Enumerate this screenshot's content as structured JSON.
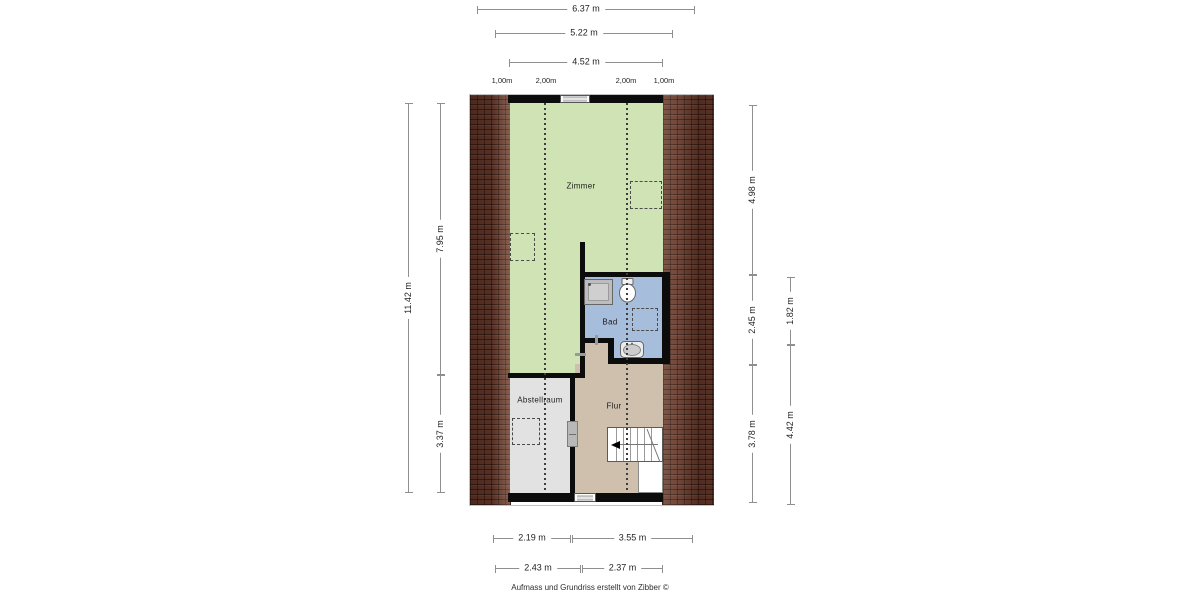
{
  "rooms": {
    "zimmer": "Zimmer",
    "bad": "Bad",
    "abstellraum": "Abstellraum",
    "flur": "Flur"
  },
  "dimensions": {
    "top": [
      "6.37 m",
      "5.22 m",
      "4.52 m"
    ],
    "top_small": [
      "1,00m",
      "2,00m",
      "2,00m",
      "1,00m"
    ],
    "left": [
      "11.42 m",
      "7.95 m",
      "3.37 m"
    ],
    "right": [
      "4.98 m",
      "2.45 m",
      "3.78 m",
      "1.82 m",
      "4.42 m"
    ],
    "bottom": [
      "2.19 m",
      "3.55 m",
      "2.43 m",
      "2.37 m"
    ]
  },
  "footer": {
    "credit": "Aufmass und Grundriss erstellt von Zibber ©"
  },
  "fixtures": [
    "shower",
    "toilet",
    "sink",
    "stairs",
    "sliding-door",
    "window"
  ],
  "colors": {
    "page_bg": "#ffffff",
    "wall": "#0c0c0c",
    "room_zimmer": "#cfe3b5",
    "room_bad": "#a6bedb",
    "room_flur": "#cfc0ae",
    "room_abstellraum": "#e2e2e2",
    "roof_brick": "#64392c",
    "dim_line": "#8f8f8f",
    "dim_text": "#1f1f1f",
    "guide_dash": "#3c3c3c",
    "door_fill": "#b8b8b8"
  }
}
